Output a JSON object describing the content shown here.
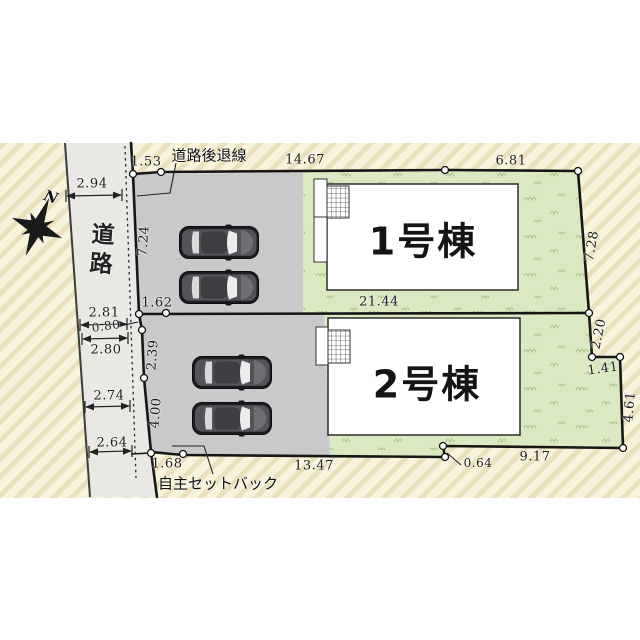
{
  "compass": {
    "label": "N"
  },
  "road": {
    "name": "道路",
    "width_top": "2.94",
    "width_upper": "2.81",
    "width_mid": "2.80",
    "width_lower": "2.74",
    "width_bottom": "2.64"
  },
  "annotations": {
    "setback_line": "道路後退線",
    "self_setback": "自主セットバック"
  },
  "lot1": {
    "building_name": "1号棟",
    "dims": {
      "north_setback": "1.53",
      "north_main": "14.67",
      "north_east": "6.81",
      "west": "7.24",
      "east": "7.28",
      "south": "21.44",
      "south_setback": "1.62"
    }
  },
  "lot2": {
    "building_name": "2号棟",
    "dims": {
      "west_offset": "0.80",
      "west_upper": "2.39",
      "west_lower": "4.00",
      "east_upper": "2.20",
      "east_step": "1.41",
      "east_lower": "4.61",
      "south_setback": "1.68",
      "south_main": "13.47",
      "south_step": "0.64",
      "south_east": "9.17"
    }
  },
  "colors": {
    "background_hatch": "#f8f3dd",
    "road_surface": "#e9e8e4",
    "driveway": "#c9c9cb",
    "lawn": "#dbe9c3",
    "building": "#ffffff",
    "boundary_line": "#161616"
  }
}
